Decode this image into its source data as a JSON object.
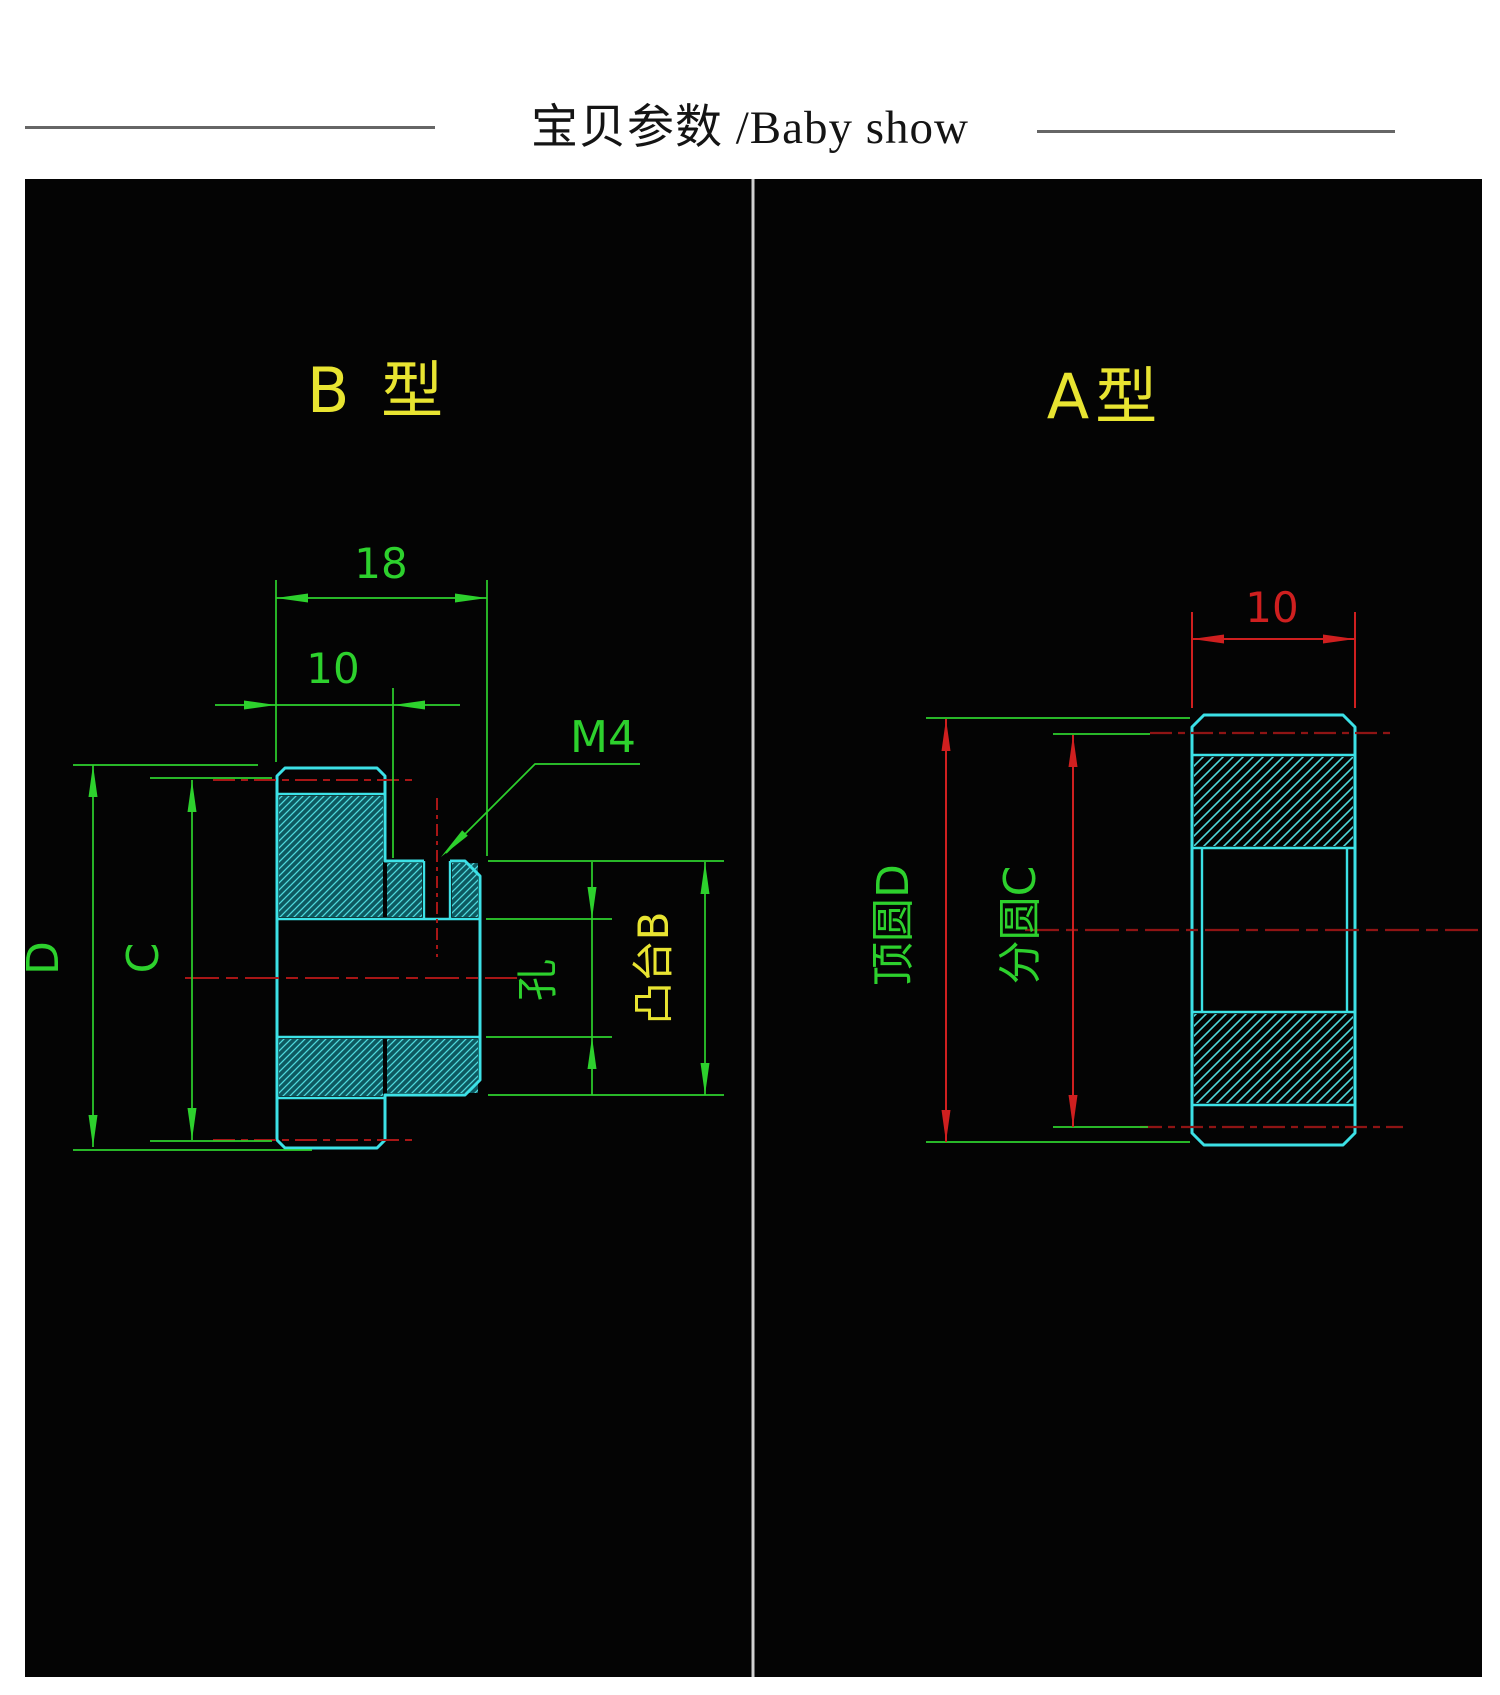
{
  "header": {
    "title": "宝贝参数 /Baby show"
  },
  "colors": {
    "green": "#2dd12d",
    "cyan": "#3ce1e6",
    "yellow": "#e8e431",
    "red_dim": "#cf1f1f",
    "red_center": "#a81616",
    "red_dark": "#8f1414",
    "hatch_teal": "#0f6e77",
    "hatch_line": "#4fd8dc",
    "divider": "#d2d2d2",
    "black": "#040404"
  },
  "panel_b": {
    "title": "B 型",
    "dim_total_width": "18",
    "dim_disc_width": "10",
    "thread_label": "M4",
    "tip_circle_label": "D",
    "pitch_circle_label": "C",
    "hole_label": "孔",
    "boss_label": "凸台B"
  },
  "panel_a": {
    "title": "A型",
    "dim_width": "10",
    "tip_circle_label": "顶圆D",
    "pitch_circle_label": "分圆C"
  }
}
